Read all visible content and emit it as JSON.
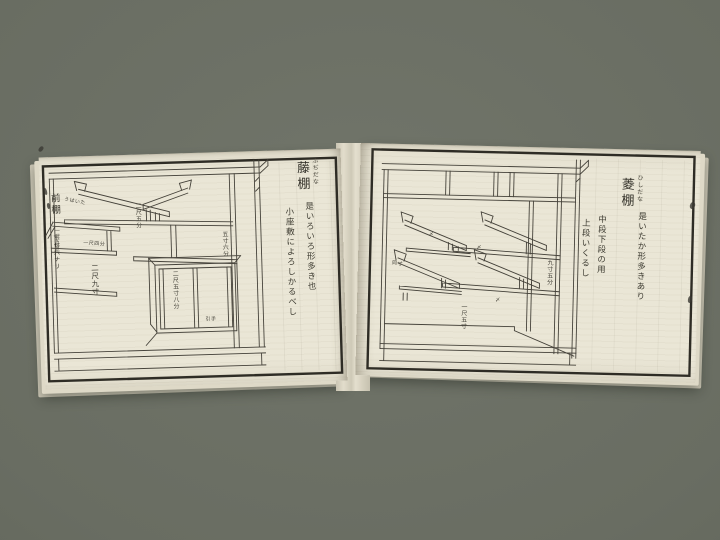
{
  "scene": {
    "background": "#696d62",
    "paper": "#eae6d6",
    "paper_edge": "#cfcab8",
    "ink": "#34322a",
    "border_ink": "#2e2c25"
  },
  "left_page": {
    "margin_title": "前棚",
    "margin_note": "下セ六ナリ",
    "title": "藤棚",
    "furigana": "ふぢだな",
    "description": {
      "col1": "是いろいろ形多き也",
      "col2": "小座敷によろしかるべし"
    },
    "labels": {
      "top_board": "うはいた",
      "left_depth": "一尺五寸",
      "lower_board": "一尺四分",
      "mid_shelf": "二尺五分",
      "height": "二尺九寸",
      "right_depth": "五寸六分",
      "cabinet_width": "二尺五寸八分",
      "door_pull": "引手"
    }
  },
  "right_page": {
    "title": "菱棚",
    "furigana": "ひしだな",
    "description": {
      "col1": "是いたか形多きあり",
      "col2": "中段下段の用",
      "col3": "上段いくるし"
    },
    "labels": {
      "same_size": "同寸",
      "right_depth": "九寸五分",
      "bottom_width": "一尺五寸",
      "pin": "〆"
    }
  }
}
